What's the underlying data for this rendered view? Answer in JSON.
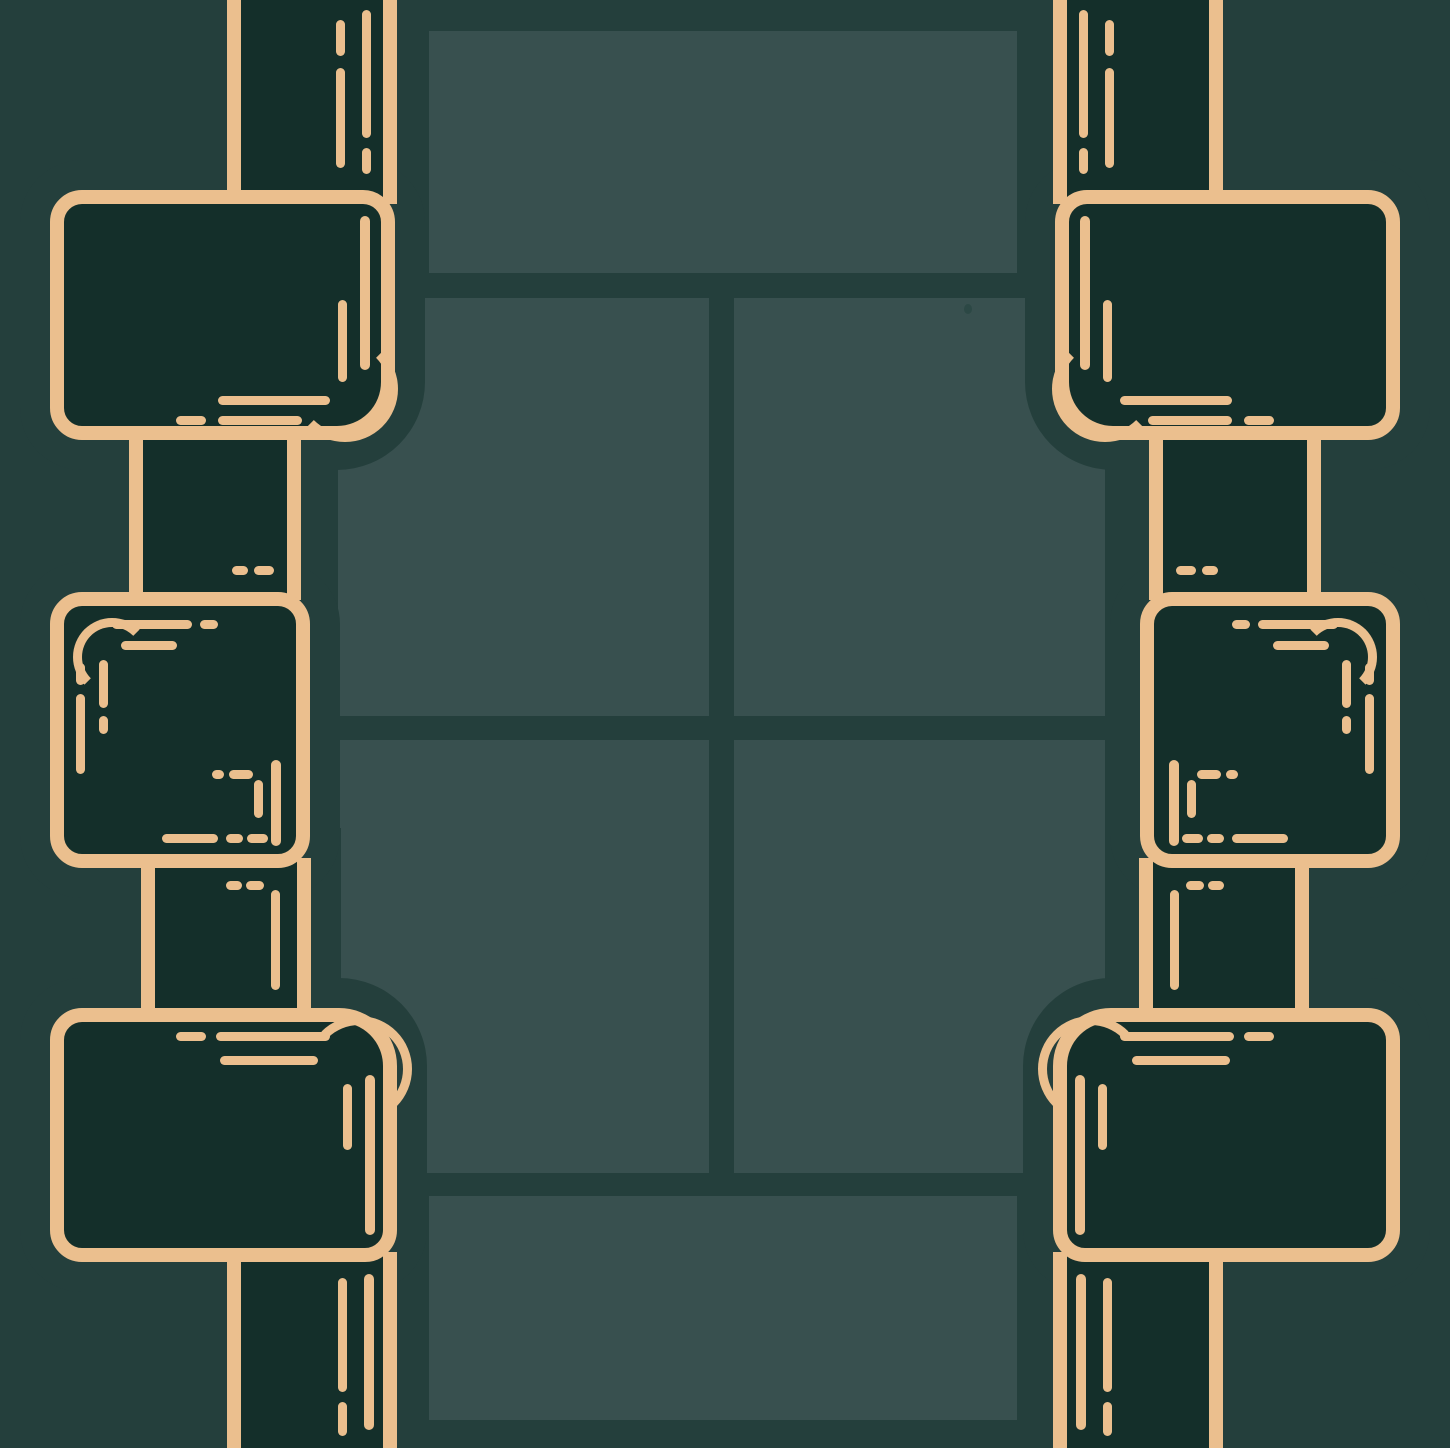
{
  "colors": {
    "background": "#243F3C",
    "panel": "#38504F",
    "box_fill": "#142F2A",
    "gold": "#EBBF8E",
    "dot": "#2C4845"
  }
}
